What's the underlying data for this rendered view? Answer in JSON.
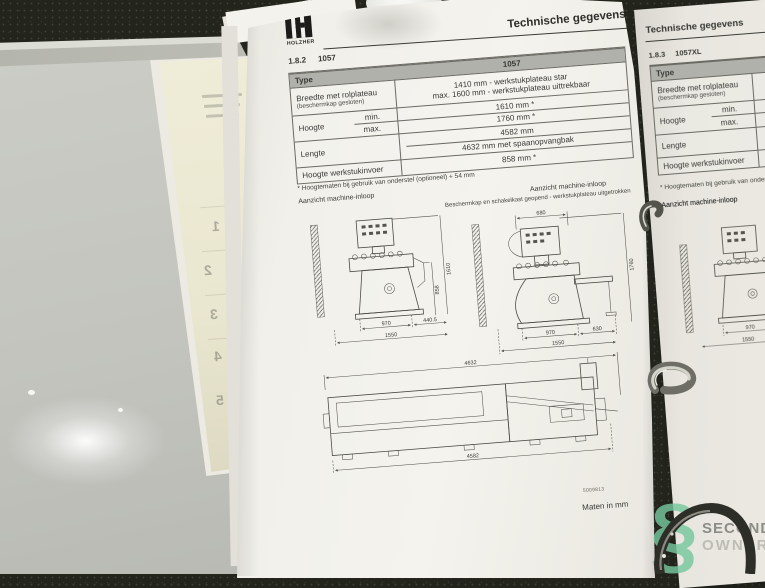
{
  "brand": {
    "name": "HOLZHER"
  },
  "main_page": {
    "header_title": "Technische gegevens",
    "section_no": "1.8.2",
    "section_model": "1057",
    "table": {
      "col_type": "Type",
      "col_value": "1057",
      "breedte_label": "Breedte met rolplateau",
      "breedte_sub": "(beschermkap gesloten)",
      "breedte_v1": "1410 mm - werkstukplateau star",
      "breedte_v2": "max. 1600 mm - werkstukplateau uittrekbaar",
      "hoogte_label": "Hoogte",
      "hoogte_min": "min.",
      "hoogte_max": "max.",
      "hoogte_min_v": "1610 mm *",
      "hoogte_max_v": "1760 mm *",
      "lengte_label": "Lengte",
      "lengte_v1": "4582 mm",
      "lengte_v2": "4632 mm met spaanopvangbak",
      "invoer_label": "Hoogte werkstukinvoer",
      "invoer_v": "858 mm *"
    },
    "footnote": "* Hoogtematen bij gebruik van onderstel (optioneel) + 54 mm",
    "view_left_caption": "Aanzicht machine-inloop",
    "view_right_caption": "Aanzicht machine-inloop",
    "view_right_subcaption": "Beschermkap en schakelkast geopend - werkstukplateau uitgetrokken",
    "dims_a": {
      "w_front": "970",
      "w_side": "440.5",
      "w_total": "1550",
      "h_infeed": "858",
      "h_total": "1610"
    },
    "dims_b": {
      "top": "680",
      "w_front": "970",
      "w_side": "630",
      "w_total": "1550",
      "h_total": "1760"
    },
    "dims_c": {
      "top": "4632",
      "bottom": "4582"
    },
    "doc_number": "5009813",
    "units_note": "Maten in mm"
  },
  "right_page": {
    "header_title": "Technische gegevens",
    "section_no": "1.8.3",
    "section_model": "1057XL",
    "table": {
      "col_type": "Type",
      "breedte_label": "Breedte met rolplateau",
      "breedte_sub": "(beschermkap gesloten)",
      "hoogte_label": "Hoogte",
      "hoogte_min": "min.",
      "hoogte_max": "max.",
      "lengte_label": "Lengte",
      "invoer_label": "Hoogte werkstukinvoer"
    },
    "footnote": "* Hoogtematen bij gebruik van onderstel (optioneel) + 54 mm",
    "view_caption": "Aanzicht machine-inloop",
    "dims": {
      "w_front": "970",
      "w_total": "1550"
    }
  },
  "divider_tabs": {
    "t1": "1",
    "t2": "2",
    "t3": "3",
    "t4": "4",
    "t5": "5"
  },
  "watermark": {
    "symbol": "§",
    "line1": "SECOND",
    "line2": "OWNER"
  },
  "colors": {
    "paper": "#f2f1eb",
    "table_header": "#b1b1ab",
    "background": "#23251d",
    "watermark_green": "#76c69e"
  }
}
